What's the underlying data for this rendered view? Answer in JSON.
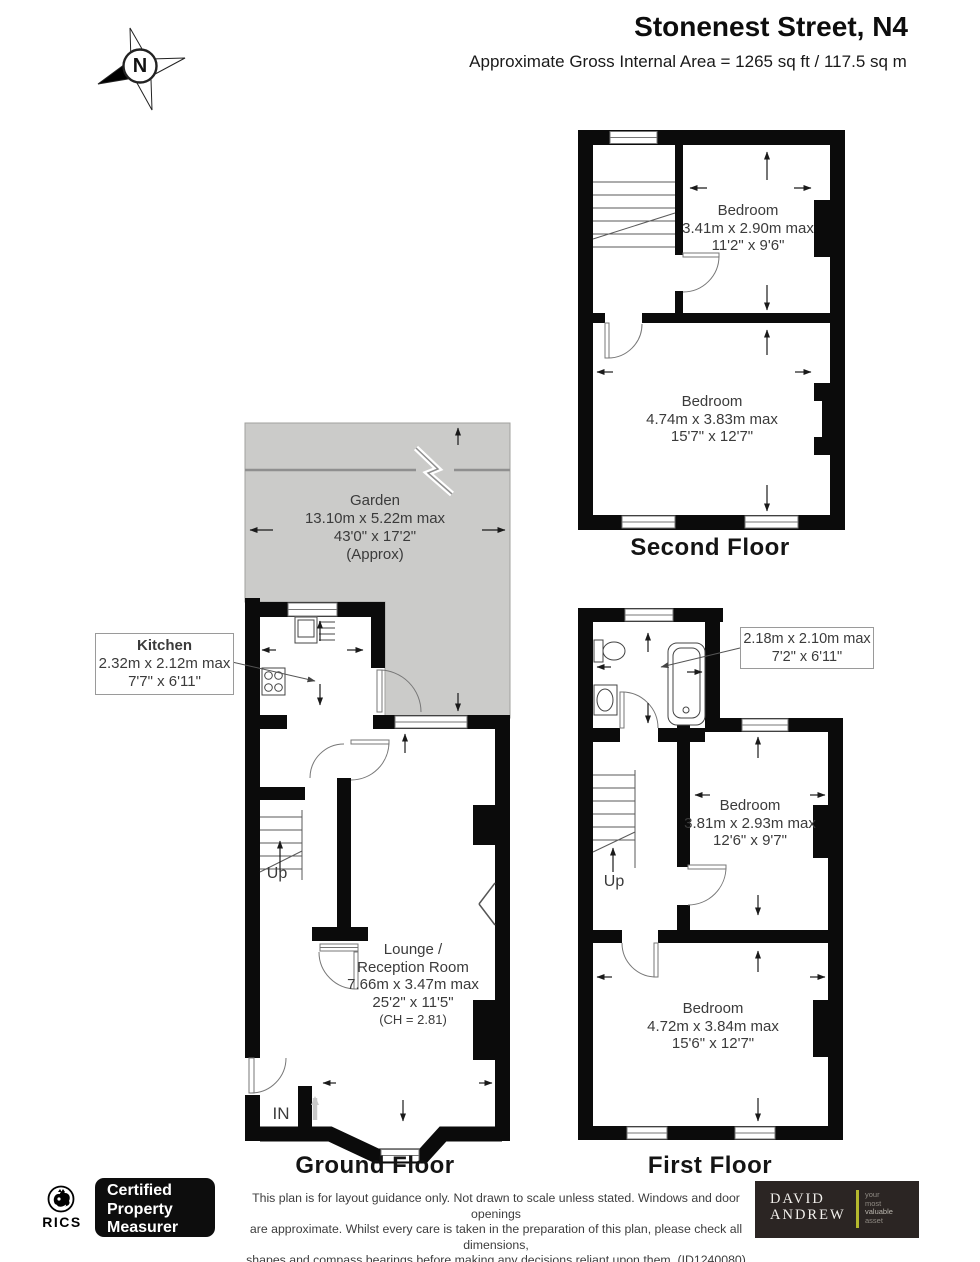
{
  "header": {
    "title": "Stonenest Street, N4",
    "subtitle": "Approximate Gross Internal Area = 1265 sq ft / 117.5 sq m"
  },
  "compass": {
    "north": "N"
  },
  "second_floor": {
    "label": "Second Floor",
    "bedroom_rear": {
      "name": "Bedroom",
      "metric": "3.41m x 2.90m max",
      "imperial": "11'2\" x 9'6\""
    },
    "bedroom_front": {
      "name": "Bedroom",
      "metric": "4.74m x 3.83m max",
      "imperial": "15'7\" x 12'7\""
    }
  },
  "first_floor": {
    "label": "First Floor",
    "up_label": "Up",
    "bathroom_callout": {
      "metric": "2.18m x 2.10m max",
      "imperial": "7'2\" x 6'11\""
    },
    "bedroom_middle": {
      "name": "Bedroom",
      "metric": "3.81m x 2.93m max",
      "imperial": "12'6\" x 9'7\""
    },
    "bedroom_front": {
      "name": "Bedroom",
      "metric": "4.72m x 3.84m max",
      "imperial": "15'6\" x 12'7\""
    }
  },
  "ground_floor": {
    "label": "Ground Floor",
    "up_label": "Up",
    "entrance_label": "IN",
    "garden": {
      "name": "Garden",
      "metric": "13.10m x 5.22m max",
      "imperial": "43'0\" x 17'2\"",
      "note": "(Approx)"
    },
    "kitchen_callout": {
      "name": "Kitchen",
      "metric": "2.32m x 2.12m  max",
      "imperial": "7'7\" x 6'11\""
    },
    "lounge": {
      "name_line1": "Lounge /",
      "name_line2": "Reception Room",
      "metric": "7.66m x 3.47m max",
      "imperial": "25'2\" x 11'5\"",
      "ceiling": "(CH = 2.81)"
    }
  },
  "footer": {
    "rics_label": "RICS",
    "certified": {
      "line1": "Certified",
      "line2": "Property",
      "line3": "Measurer"
    },
    "disclaimer": {
      "line1": "This plan is for layout guidance only. Not drawn to scale unless stated. Windows and door openings",
      "line2": "are approximate. Whilst every care is taken in the preparation of this plan, please check all dimensions,",
      "line3": "shapes and compass bearings before making any decisions reliant upon them. (ID1240080)"
    },
    "brand": {
      "name_line1": "DAVID",
      "name_line2": "ANDREW",
      "tagline_line1": "your",
      "tagline_line2": "most",
      "tagline_line3": "valuable",
      "tagline_line4": "asset"
    }
  },
  "colors": {
    "wall": "#0b0b0b",
    "garden_fill": "#cbcbc9",
    "fence_line": "#8f8f8f",
    "brand_bg": "#2b2523",
    "brand_accent": "#b5b92e"
  }
}
